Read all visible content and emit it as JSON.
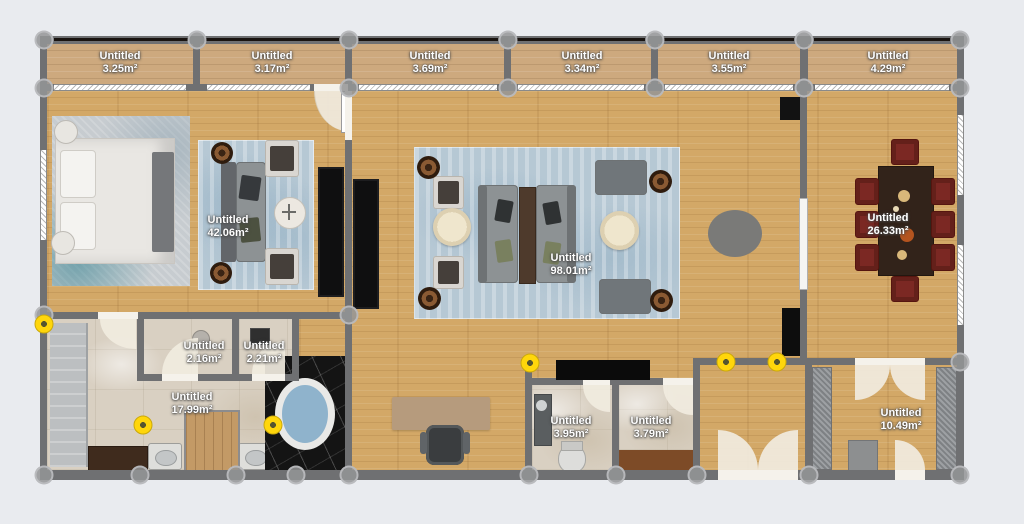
{
  "plan": {
    "type": "floor-plan-canvas",
    "rooms": [
      {
        "id": "balcony-1",
        "name": "Untitled",
        "area": "3.25m²"
      },
      {
        "id": "balcony-2",
        "name": "Untitled",
        "area": "3.17m²"
      },
      {
        "id": "balcony-3",
        "name": "Untitled",
        "area": "3.69m²"
      },
      {
        "id": "balcony-4",
        "name": "Untitled",
        "area": "3.34m²"
      },
      {
        "id": "balcony-5",
        "name": "Untitled",
        "area": "3.55m²"
      },
      {
        "id": "balcony-6",
        "name": "Untitled",
        "area": "4.29m²"
      },
      {
        "id": "bedroom-suite",
        "name": "Untitled",
        "area": "42.06m²"
      },
      {
        "id": "living-room",
        "name": "Untitled",
        "area": "98.01m²"
      },
      {
        "id": "dining-room",
        "name": "Untitled",
        "area": "26.33m²"
      },
      {
        "id": "wc-small-1",
        "name": "Untitled",
        "area": "2.16m²"
      },
      {
        "id": "wc-small-2",
        "name": "Untitled",
        "area": "2.21m²"
      },
      {
        "id": "bathroom",
        "name": "Untitled",
        "area": "17.99m²"
      },
      {
        "id": "toilet",
        "name": "Untitled",
        "area": "3.95m²"
      },
      {
        "id": "utility",
        "name": "Untitled",
        "area": "3.79m²"
      },
      {
        "id": "entry",
        "name": "Untitled",
        "area": "10.49m²"
      }
    ],
    "colors": {
      "background": "#e9ebef",
      "wall": "#6f7072",
      "floor_wood": "#d3a867",
      "balcony_wood": "#cda97e",
      "marble": "#d9d0c2",
      "black_marble": "#141414",
      "rug_blue": "#b6c8d4",
      "dining_table": "#32231a",
      "chair_maroon": "#7b2823",
      "opening_marker": "#ffd60b",
      "node_gray": "#949597"
    }
  }
}
